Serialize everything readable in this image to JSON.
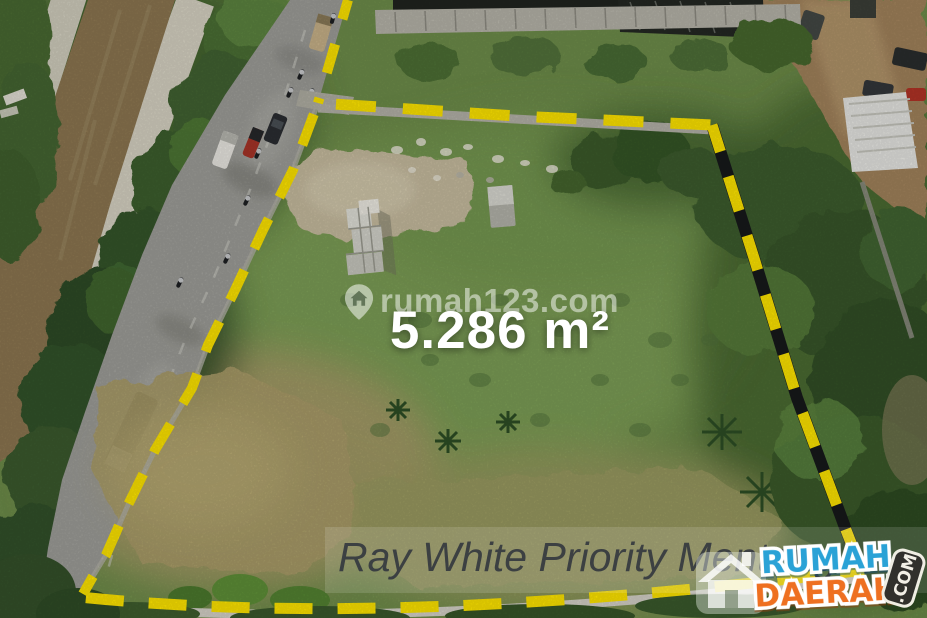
{
  "photo": {
    "kind": "aerial drone photo of vacant land plot for sale",
    "area_label": "5.286 m²",
    "watermark_text": "rumah123.com",
    "agent_text": "Ray White Priority Menteng",
    "boundary_color": "#ffe600"
  },
  "logo": {
    "word_top": "RUMAH",
    "word_bottom": "DAERAH",
    "suffix": ".COM",
    "color_top": "#2aa2d6",
    "color_bottom": "#ee7021",
    "suffix_bg": "#31302c"
  }
}
